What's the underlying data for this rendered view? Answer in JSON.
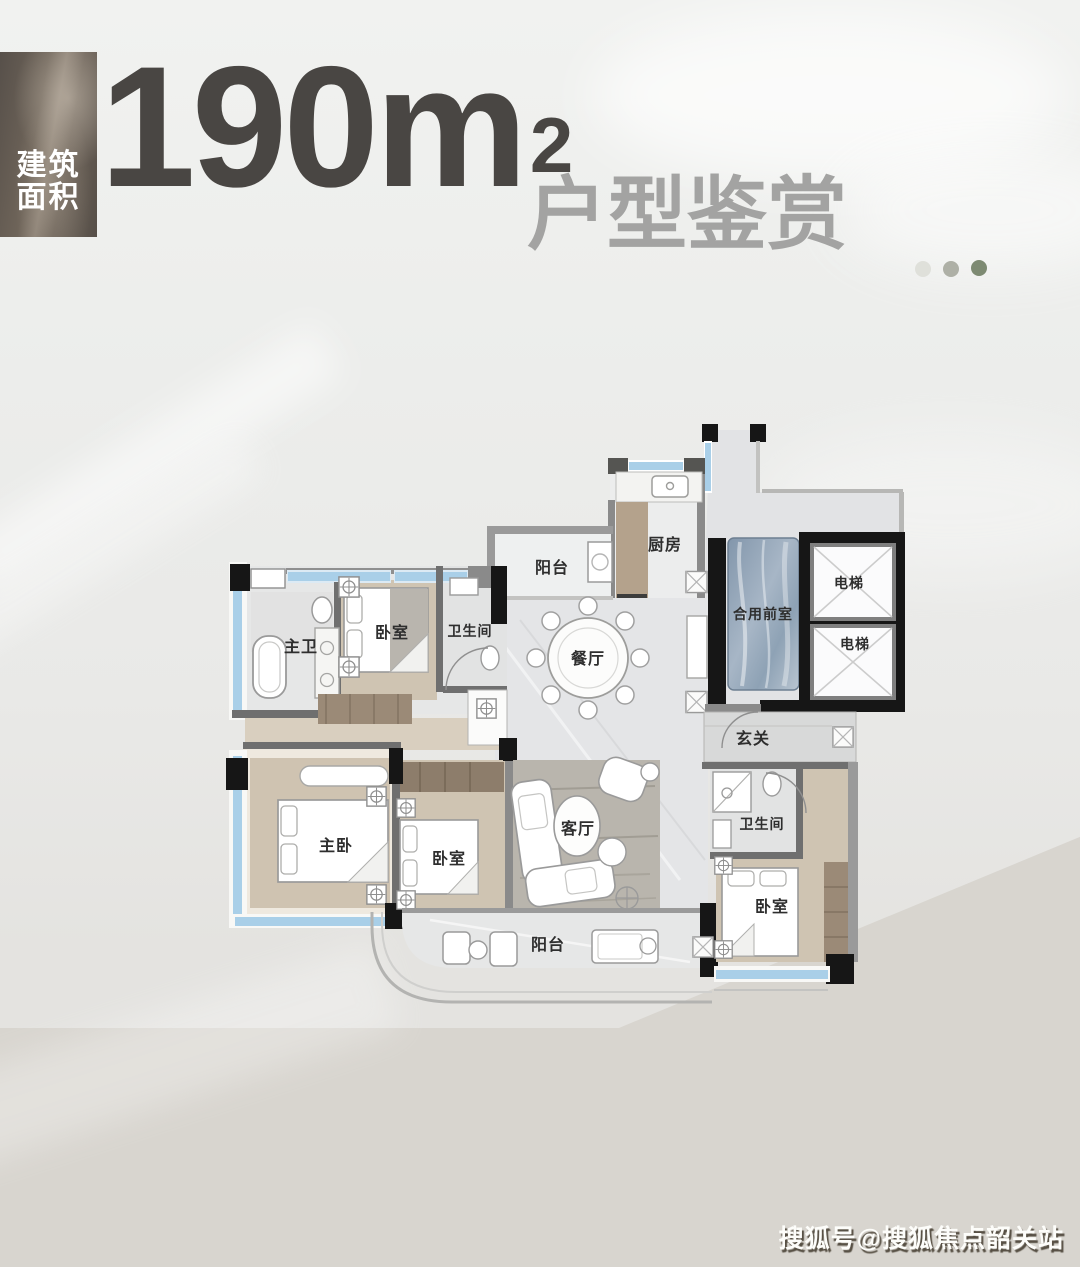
{
  "header": {
    "badge": {
      "line1": "建筑",
      "line2": "面积"
    },
    "area": {
      "value": "190m",
      "superscript": "2"
    },
    "title": "户型鉴赏",
    "carousel_dots": [
      {
        "state": "inactive",
        "color": "#dfe0da"
      },
      {
        "state": "inactive",
        "color": "#aeb0a6"
      },
      {
        "state": "active",
        "color": "#7d8a72"
      }
    ]
  },
  "floorplan": {
    "labels": {
      "balcony_north": "阳台",
      "kitchen": "厨房",
      "dining": "餐厅",
      "shared_vestibule": "合用前室",
      "elevator_a": "电梯",
      "elevator_b": "电梯",
      "master_bath": "主卫",
      "bedroom_north": "卧室",
      "bath_north": "卫生间",
      "foyer": "玄关",
      "bath_east": "卫生间",
      "master_bedroom": "主卧",
      "bedroom_middle": "卧室",
      "living_room": "客厅",
      "balcony_south": "阳台",
      "bedroom_east": "卧室"
    }
  },
  "watermark": "搜狐号@搜狐焦点韶关站"
}
